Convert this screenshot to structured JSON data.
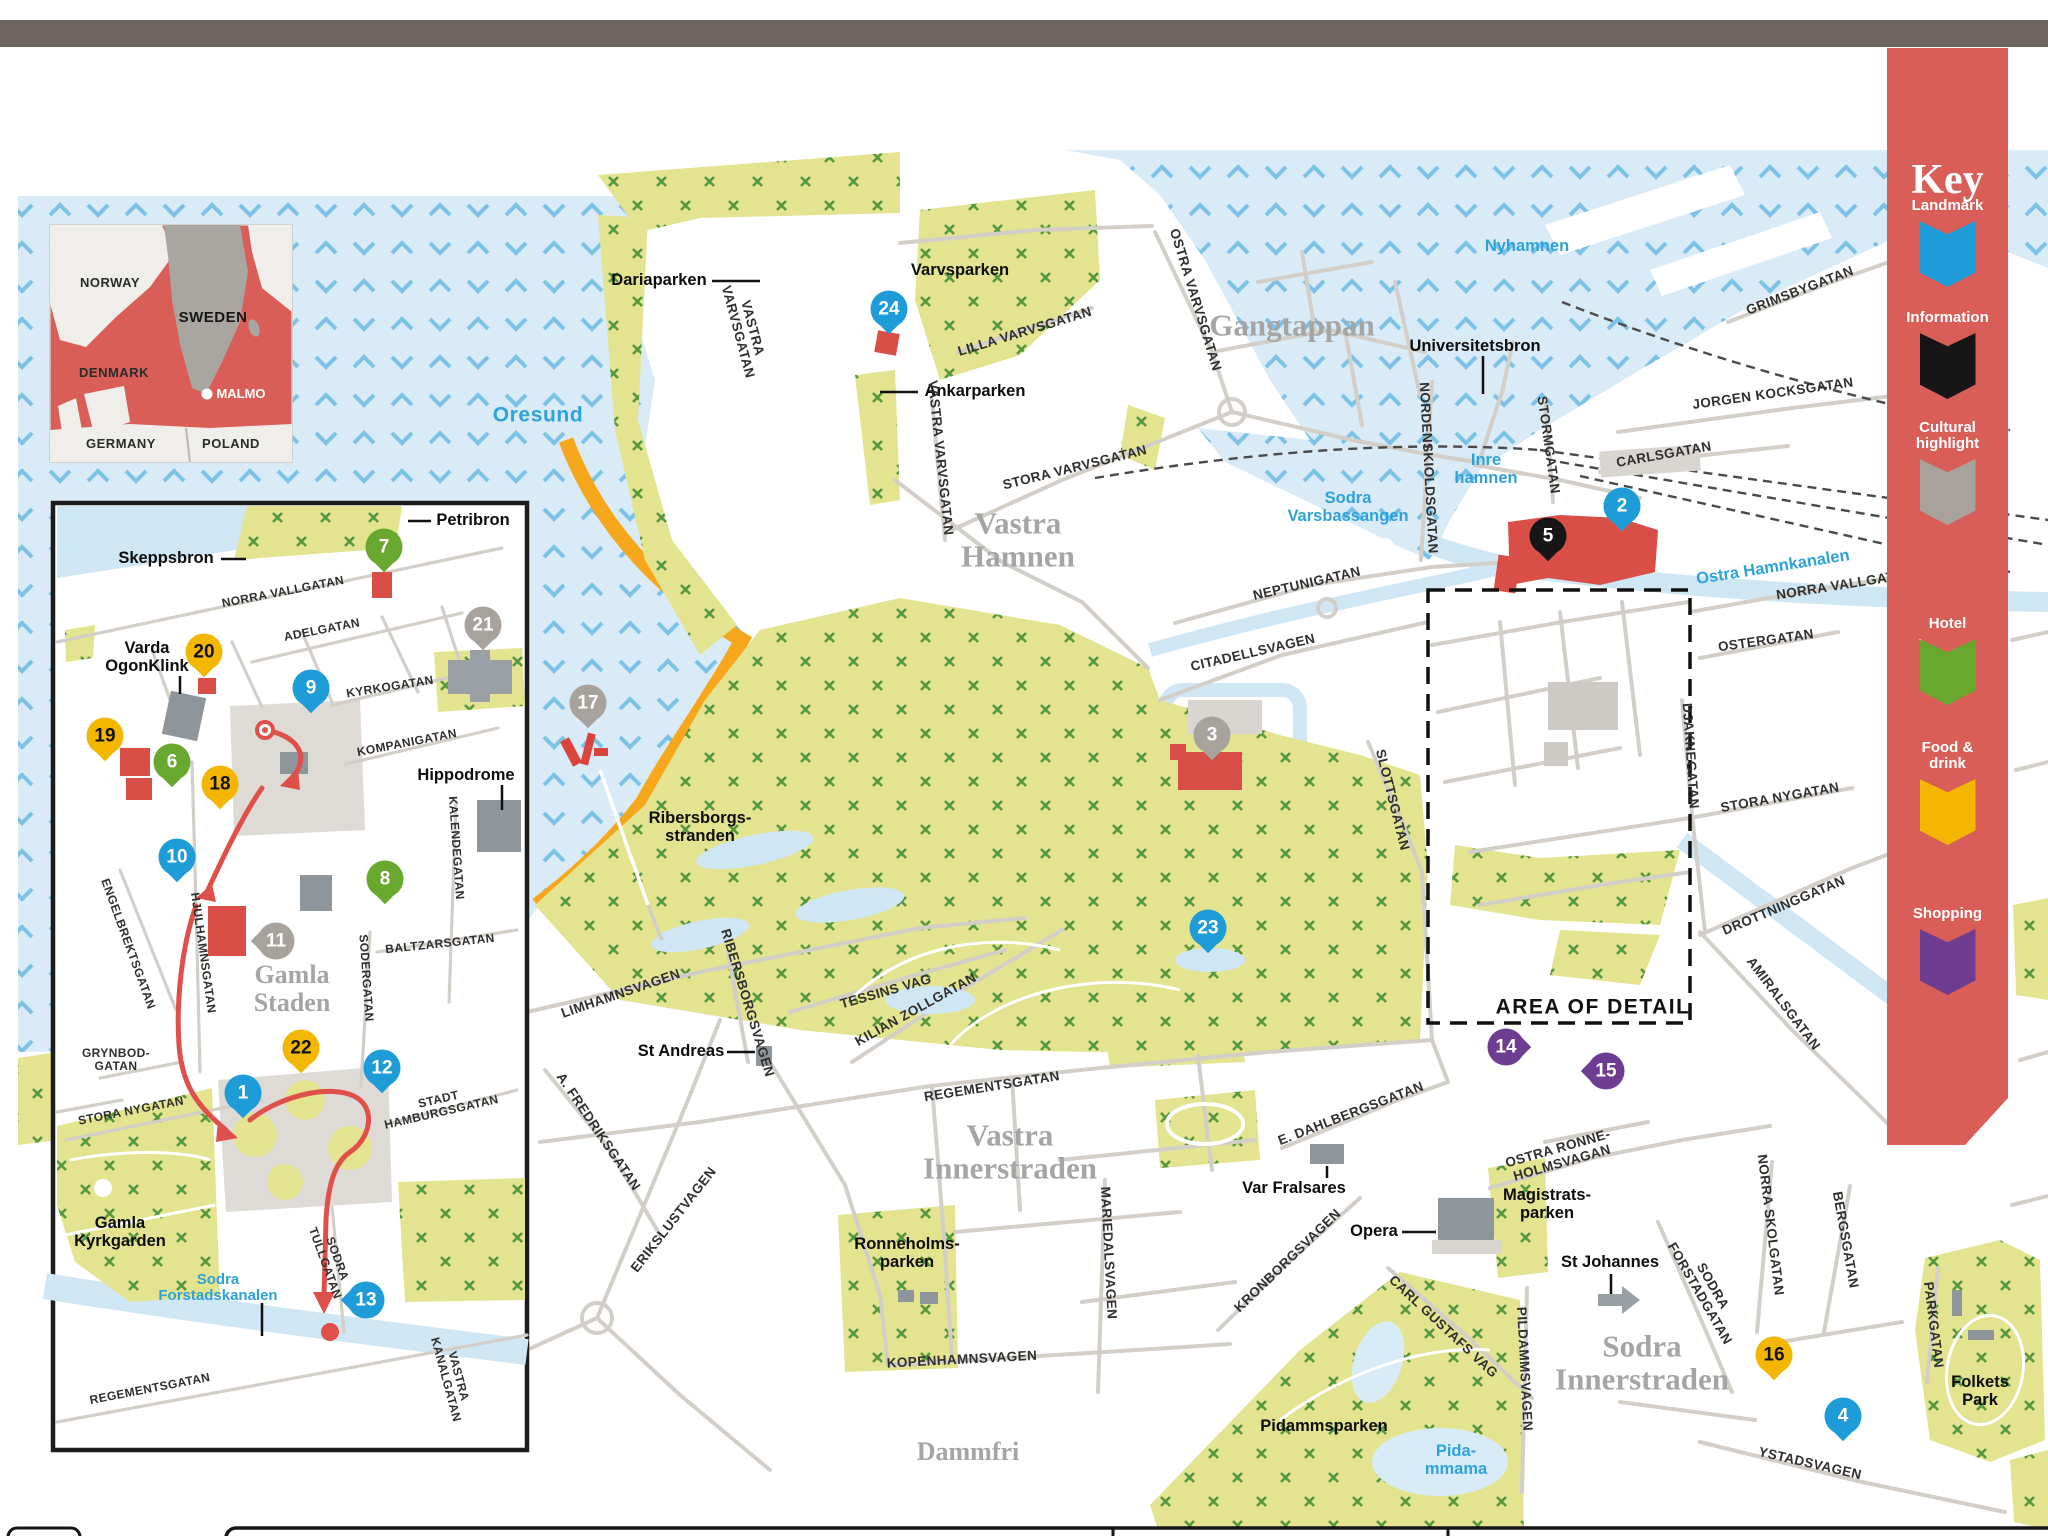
{
  "key": {
    "title": "Key",
    "background": "#d95e57",
    "items": [
      {
        "id": "landmark",
        "label": "Landmark",
        "color": "#1e9cd8",
        "icon": "eye-icon",
        "top": 150
      },
      {
        "id": "information",
        "label": "Information",
        "color": "#161616",
        "icon": "info-icon",
        "top": 262
      },
      {
        "id": "cultural",
        "label": "Cultural\nhighlight",
        "color": "#a8a29c",
        "icon": "museum-icon",
        "top": 372
      },
      {
        "id": "hotel",
        "label": "Hotel",
        "color": "#69a82f",
        "icon": "bed-icon",
        "top": 568
      },
      {
        "id": "food",
        "label": "Food &\ndrink",
        "color": "#f4b701",
        "icon": "cutlery-icon",
        "top": 692
      },
      {
        "id": "shopping",
        "label": "Shopping",
        "color": "#6e3d92",
        "icon": "bag-icon",
        "top": 858
      }
    ]
  },
  "marker_colors": {
    "landmark": {
      "bg": "#1e9cd8",
      "fg": "#ffffff"
    },
    "information": {
      "bg": "#161616",
      "fg": "#ffffff"
    },
    "cultural": {
      "bg": "#a8a29c",
      "fg": "#ffffff"
    },
    "hotel": {
      "bg": "#69a82f",
      "fg": "#ffffff"
    },
    "food": {
      "bg": "#f4b701",
      "fg": "#111111"
    },
    "shopping": {
      "bg": "#6e3d92",
      "fg": "#ffffff"
    }
  },
  "markers": [
    {
      "n": "1",
      "cat": "landmark",
      "x": 243,
      "y": 1093,
      "tail": "down"
    },
    {
      "n": "2",
      "cat": "landmark",
      "x": 1622,
      "y": 506,
      "tail": "down"
    },
    {
      "n": "3",
      "cat": "cultural",
      "x": 1212,
      "y": 735,
      "tail": "down"
    },
    {
      "n": "4",
      "cat": "landmark",
      "x": 1843,
      "y": 1416,
      "tail": "down"
    },
    {
      "n": "5",
      "cat": "information",
      "x": 1548,
      "y": 536,
      "tail": "down"
    },
    {
      "n": "6",
      "cat": "hotel",
      "x": 172,
      "y": 762,
      "tail": "down"
    },
    {
      "n": "7",
      "cat": "hotel",
      "x": 384,
      "y": 547,
      "tail": "down"
    },
    {
      "n": "8",
      "cat": "hotel",
      "x": 385,
      "y": 879,
      "tail": "down"
    },
    {
      "n": "9",
      "cat": "landmark",
      "x": 311,
      "y": 688,
      "tail": "down"
    },
    {
      "n": "10",
      "cat": "landmark",
      "x": 177,
      "y": 857,
      "tail": "down"
    },
    {
      "n": "11",
      "cat": "cultural",
      "x": 276,
      "y": 941,
      "tail": "left"
    },
    {
      "n": "12",
      "cat": "landmark",
      "x": 382,
      "y": 1068,
      "tail": "down"
    },
    {
      "n": "13",
      "cat": "landmark",
      "x": 366,
      "y": 1300,
      "tail": "left"
    },
    {
      "n": "14",
      "cat": "shopping",
      "x": 1506,
      "y": 1047,
      "tail": "right"
    },
    {
      "n": "15",
      "cat": "shopping",
      "x": 1606,
      "y": 1071,
      "tail": "left"
    },
    {
      "n": "16",
      "cat": "food",
      "x": 1774,
      "y": 1355,
      "tail": "down"
    },
    {
      "n": "17",
      "cat": "cultural",
      "x": 588,
      "y": 703,
      "tail": "down"
    },
    {
      "n": "18",
      "cat": "food",
      "x": 220,
      "y": 784,
      "tail": "down"
    },
    {
      "n": "19",
      "cat": "food",
      "x": 105,
      "y": 736,
      "tail": "down"
    },
    {
      "n": "20",
      "cat": "food",
      "x": 204,
      "y": 652,
      "tail": "down"
    },
    {
      "n": "21",
      "cat": "cultural",
      "x": 483,
      "y": 625,
      "tail": "down"
    },
    {
      "n": "22",
      "cat": "food",
      "x": 301,
      "y": 1048,
      "tail": "down"
    },
    {
      "n": "23",
      "cat": "landmark",
      "x": 1208,
      "y": 928,
      "tail": "down"
    },
    {
      "n": "24",
      "cat": "landmark",
      "x": 889,
      "y": 309,
      "tail": "down"
    }
  ],
  "labels": [
    {
      "text": "Oresund",
      "x": 538,
      "y": 416,
      "cls": "water big"
    },
    {
      "text": "Nyhamnen",
      "x": 1527,
      "y": 247,
      "cls": "water"
    },
    {
      "text": "Inre\nhamnen",
      "x": 1486,
      "y": 470,
      "cls": "water"
    },
    {
      "text": "Sodra\nVarsbassangen",
      "x": 1348,
      "y": 508,
      "cls": "water"
    },
    {
      "text": "Ostra Hamnkanalen",
      "x": 1773,
      "y": 568,
      "cls": "water",
      "rot": -9
    },
    {
      "text": "Sodra\nForstadskanalen",
      "x": 218,
      "y": 1288,
      "cls": "water small"
    },
    {
      "text": "Pida-\nmmama",
      "x": 1456,
      "y": 1461,
      "cls": "water"
    },
    {
      "text": "Vastra\nHamnen",
      "x": 1018,
      "y": 540,
      "cls": "district"
    },
    {
      "text": "Gangtappan",
      "x": 1292,
      "y": 325,
      "cls": "district"
    },
    {
      "text": "Vastra\nInnerstraden",
      "x": 1010,
      "y": 1152,
      "cls": "district"
    },
    {
      "text": "Sodra\nInnerstraden",
      "x": 1642,
      "y": 1363,
      "cls": "district"
    },
    {
      "text": "Gamla\nStaden",
      "x": 292,
      "y": 989,
      "cls": "district small"
    },
    {
      "text": "Dammfri",
      "x": 968,
      "y": 1452,
      "cls": "district small"
    },
    {
      "text": "Dariaparken",
      "x": 659,
      "y": 281,
      "cls": "place"
    },
    {
      "text": "Varvsparken",
      "x": 960,
      "y": 271,
      "cls": "place"
    },
    {
      "text": "Ankarparken",
      "x": 975,
      "y": 392,
      "cls": "place"
    },
    {
      "text": "Universitetsbron",
      "x": 1475,
      "y": 347,
      "cls": "place"
    },
    {
      "text": "St Andreas",
      "x": 681,
      "y": 1052,
      "cls": "place"
    },
    {
      "text": "Var Fralsares",
      "x": 1294,
      "y": 1189,
      "cls": "place"
    },
    {
      "text": "Opera",
      "x": 1374,
      "y": 1232,
      "cls": "place"
    },
    {
      "text": "Magistrats-\nparken",
      "x": 1547,
      "y": 1205,
      "cls": "place center"
    },
    {
      "text": "St Johannes",
      "x": 1610,
      "y": 1263,
      "cls": "place"
    },
    {
      "text": "Pidammsparken",
      "x": 1324,
      "y": 1427,
      "cls": "place"
    },
    {
      "text": "Folkets\nPark",
      "x": 1980,
      "y": 1392,
      "cls": "place center"
    },
    {
      "text": "Ronneholms-\nparken",
      "x": 907,
      "y": 1254,
      "cls": "place center"
    },
    {
      "text": "Ribersborgs-\nstranden",
      "x": 700,
      "y": 828,
      "cls": "place center"
    },
    {
      "text": "Petribron",
      "x": 473,
      "y": 521,
      "cls": "place"
    },
    {
      "text": "Skeppsbron",
      "x": 166,
      "y": 559,
      "cls": "place"
    },
    {
      "text": "Varda\nOgonKlink",
      "x": 147,
      "y": 658,
      "cls": "place center"
    },
    {
      "text": "Hippodrome",
      "x": 466,
      "y": 776,
      "cls": "place"
    },
    {
      "text": "Gamla\nKyrkgarden",
      "x": 120,
      "y": 1233,
      "cls": "place center"
    },
    {
      "text": "AREA OF DETAIL",
      "x": 1593,
      "y": 1008,
      "cls": "area"
    },
    {
      "text": "OSTRA VARVSGATAN",
      "x": 1195,
      "y": 300,
      "cls": "street",
      "rot": 73
    },
    {
      "text": "STORA VARVSGATAN",
      "x": 1075,
      "y": 468,
      "cls": "street",
      "rot": -14
    },
    {
      "text": "LILLA VARVSGATAN",
      "x": 1025,
      "y": 332,
      "cls": "street",
      "rot": -17
    },
    {
      "text": "VASTRA\nVARVSGATAN",
      "x": 745,
      "y": 330,
      "cls": "street",
      "rot": 75
    },
    {
      "text": "VASTRA VARVSGATAN",
      "x": 940,
      "y": 458,
      "cls": "street",
      "rot": 84
    },
    {
      "text": "NORDENSKIOLDSGATAN",
      "x": 1428,
      "y": 468,
      "cls": "street",
      "rot": 87
    },
    {
      "text": "STORMGATAN",
      "x": 1548,
      "y": 445,
      "cls": "street",
      "rot": 82
    },
    {
      "text": "GRIMSBYGATAN",
      "x": 1800,
      "y": 291,
      "cls": "street",
      "rot": -21
    },
    {
      "text": "JORGEN KOCKSGATAN",
      "x": 1773,
      "y": 394,
      "cls": "street",
      "rot": -8
    },
    {
      "text": "CARLSGATAN",
      "x": 1664,
      "y": 455,
      "cls": "street",
      "rot": -10
    },
    {
      "text": "NORRA VALLGATAN",
      "x": 1845,
      "y": 585,
      "cls": "street",
      "rot": -9
    },
    {
      "text": "OSTERGATAN",
      "x": 1766,
      "y": 641,
      "cls": "street",
      "rot": -8
    },
    {
      "text": "NEPTUNIGATAN",
      "x": 1307,
      "y": 584,
      "cls": "street",
      "rot": -13
    },
    {
      "text": "CITADELLSVAGEN",
      "x": 1253,
      "y": 653,
      "cls": "street",
      "rot": -13
    },
    {
      "text": "SLOTTSGATAN",
      "x": 1392,
      "y": 800,
      "cls": "street",
      "rot": 76
    },
    {
      "text": "DJAKNEGATAN",
      "x": 1690,
      "y": 756,
      "cls": "street",
      "rot": 86
    },
    {
      "text": "STORA NYGATAN",
      "x": 1780,
      "y": 798,
      "cls": "street",
      "rot": -10
    },
    {
      "text": "DROTTNINGGATAN",
      "x": 1784,
      "y": 906,
      "cls": "street",
      "rot": -23
    },
    {
      "text": "AMIRALSGATAN",
      "x": 1783,
      "y": 1004,
      "cls": "street",
      "rot": 53
    },
    {
      "text": "E. DAHLBERGSGATAN",
      "x": 1351,
      "y": 1114,
      "cls": "street",
      "rot": -21
    },
    {
      "text": "OSTRA RONNE-\nHOLMSVAGAN",
      "x": 1560,
      "y": 1156,
      "cls": "street",
      "rot": -16
    },
    {
      "text": "NORRA SKOLGATAN",
      "x": 1770,
      "y": 1225,
      "cls": "street",
      "rot": 83
    },
    {
      "text": "BERGSGATAN",
      "x": 1845,
      "y": 1240,
      "cls": "street",
      "rot": 80
    },
    {
      "text": "SODRA\nFORSTADGATAN",
      "x": 1706,
      "y": 1290,
      "cls": "street",
      "rot": 60
    },
    {
      "text": "PARKGATAN",
      "x": 1933,
      "y": 1325,
      "cls": "street",
      "rot": 83
    },
    {
      "text": "YSTADSVAGEN",
      "x": 1810,
      "y": 1464,
      "cls": "street",
      "rot": 13
    },
    {
      "text": "KOPENHAMNSVAGEN",
      "x": 962,
      "y": 1360,
      "cls": "street",
      "rot": -3
    },
    {
      "text": "MARIEDALSVAGEN",
      "x": 1108,
      "y": 1253,
      "cls": "street",
      "rot": 87
    },
    {
      "text": "KRONBORGSVAGEN",
      "x": 1288,
      "y": 1261,
      "cls": "street",
      "rot": -44
    },
    {
      "text": "CARL GUSTAFS VAG",
      "x": 1443,
      "y": 1327,
      "cls": "street",
      "rot": 43
    },
    {
      "text": "PILDAMMSVAGEN",
      "x": 1524,
      "y": 1369,
      "cls": "street",
      "rot": 87
    },
    {
      "text": "REGEMENTSGATAN",
      "x": 992,
      "y": 1087,
      "cls": "street",
      "rot": -9
    },
    {
      "text": "LIMHAMNSVAGEN",
      "x": 621,
      "y": 994,
      "cls": "street",
      "rot": -19
    },
    {
      "text": "A. FREDRIKSGATAN",
      "x": 598,
      "y": 1132,
      "cls": "street",
      "rot": 56
    },
    {
      "text": "ERIKSLUSTVAGEN",
      "x": 674,
      "y": 1220,
      "cls": "street",
      "rot": -52
    },
    {
      "text": "TESSINS VAG",
      "x": 886,
      "y": 992,
      "cls": "street",
      "rot": -16
    },
    {
      "text": "KILIAN ZOLLGATAN",
      "x": 916,
      "y": 1010,
      "cls": "street",
      "rot": -29
    },
    {
      "text": "RIBERSBORGSVAGEN",
      "x": 747,
      "y": 1003,
      "cls": "street",
      "rot": 73
    },
    {
      "text": "NORRA VALLGATAN",
      "x": 283,
      "y": 592,
      "cls": "street sm",
      "rot": -11
    },
    {
      "text": "ADELGATAN",
      "x": 322,
      "y": 630,
      "cls": "street sm",
      "rot": -11
    },
    {
      "text": "KYRKOGATAN",
      "x": 390,
      "y": 687,
      "cls": "street sm",
      "rot": -9
    },
    {
      "text": "KOMPANIGATAN",
      "x": 407,
      "y": 743,
      "cls": "street sm",
      "rot": -11
    },
    {
      "text": "ENGELBREKTSGATAN",
      "x": 128,
      "y": 944,
      "cls": "street sm",
      "rot": 70
    },
    {
      "text": "HJULHAMNSGATAN",
      "x": 203,
      "y": 953,
      "cls": "street sm",
      "rot": 82
    },
    {
      "text": "SODERGATAN",
      "x": 366,
      "y": 978,
      "cls": "street sm",
      "rot": 86
    },
    {
      "text": "BALTZARSGATAN",
      "x": 440,
      "y": 944,
      "cls": "street sm",
      "rot": -6
    },
    {
      "text": "KALENDEGATAN",
      "x": 456,
      "y": 848,
      "cls": "street sm",
      "rot": 86
    },
    {
      "text": "GRYNBOD-\nGATAN",
      "x": 116,
      "y": 1060,
      "cls": "street sm"
    },
    {
      "text": "STORA NYGATAN",
      "x": 131,
      "y": 1111,
      "cls": "street sm",
      "rot": -11
    },
    {
      "text": "STADT\nHAMBURGSGATAN",
      "x": 440,
      "y": 1106,
      "cls": "street sm",
      "rot": -13
    },
    {
      "text": "SODRA\nTULLGATAN",
      "x": 331,
      "y": 1261,
      "cls": "street sm",
      "rot": 70
    },
    {
      "text": "VASTRA\nKANALGATAN",
      "x": 452,
      "y": 1378,
      "cls": "street sm",
      "rot": 75
    },
    {
      "text": "REGEMENTSGATAN",
      "x": 150,
      "y": 1389,
      "cls": "street sm",
      "rot": -11
    }
  ],
  "country_inset": {
    "labels": [
      {
        "text": "NORWAY",
        "x": 110,
        "y": 283,
        "cls": "ci-country"
      },
      {
        "text": "SWEDEN",
        "x": 213,
        "y": 318,
        "cls": "ci-country ci-big"
      },
      {
        "text": "DENMARK",
        "x": 114,
        "y": 373,
        "cls": "ci-country"
      },
      {
        "text": "MALMO",
        "x": 241,
        "y": 394,
        "cls": "ci-malmo"
      },
      {
        "text": "GERMANY",
        "x": 121,
        "y": 444,
        "cls": "ci-country"
      },
      {
        "text": "POLAND",
        "x": 231,
        "y": 444,
        "cls": "ci-country"
      }
    ]
  }
}
